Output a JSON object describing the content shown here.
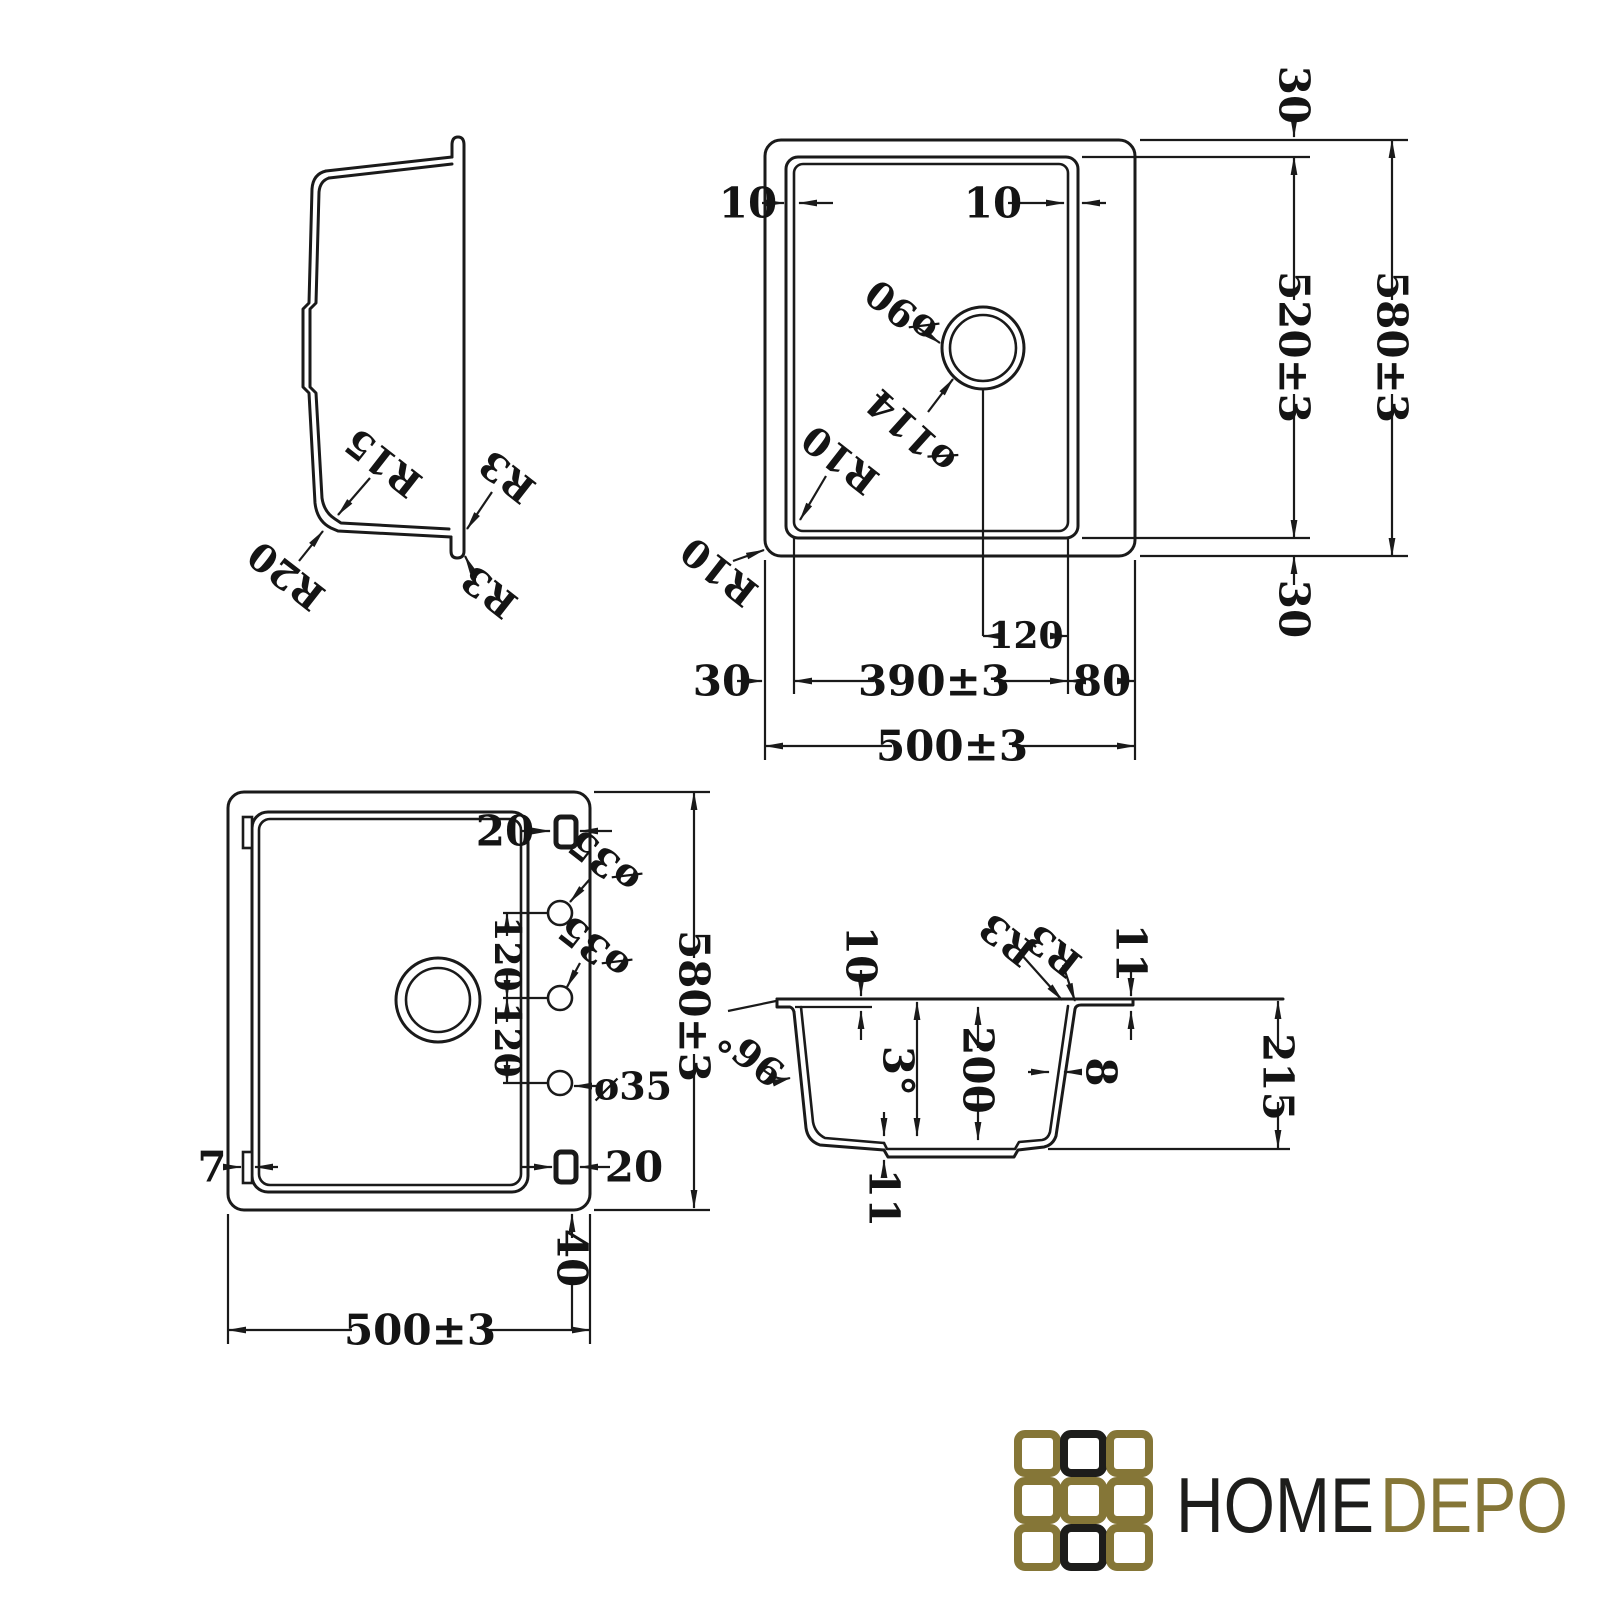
{
  "colors": {
    "ink": "#1a1a1a",
    "background": "#ffffff",
    "logo_gold": "#857637",
    "logo_black": "#1d1d1b"
  },
  "side_view": {
    "radius_inner_bottom": "R15",
    "radius_outer_bottom": "R20",
    "radius_edge_upper": "R3",
    "radius_edge_lower": "R3"
  },
  "top_view": {
    "rim_gap_left": "10",
    "rim_gap_right": "10",
    "drain_hole_dia": "ø90",
    "drain_flange_dia": "ø114",
    "corner_radius_bowl": "R10",
    "corner_radius_outer": "R10",
    "margin_top": "30",
    "bowl_height": "520±3",
    "total_height": "580±3",
    "margin_bottom": "30",
    "drain_offset": "120",
    "margin_left": "30",
    "bowl_width": "390±3",
    "margin_right": "80",
    "total_width": "500±3"
  },
  "bottom_view": {
    "clip_top": "20",
    "hole_top_dia": "ø35",
    "hole_mid_dia": "ø35",
    "hole_bottom_dia": "ø35",
    "hole_spacing_upper": "120",
    "hole_spacing_lower": "120",
    "total_height": "580±3",
    "tab_width": "7",
    "clip_bottom": "20",
    "base_offset": "40",
    "total_width": "500±3"
  },
  "section_view": {
    "rim_drop": "10",
    "fillet_inner": "R3",
    "fillet_outer": "R3",
    "rim_step": "11",
    "corner_angle": "96°",
    "draft_angle": "3°",
    "bowl_depth": "200",
    "wall_thickness": "8",
    "total_depth": "215",
    "bottom_thickness": "11"
  },
  "logo": {
    "home": "HOME",
    "depo": "DEPO",
    "gold_hex": "#857637",
    "black_hex": "#1d1d1b"
  }
}
